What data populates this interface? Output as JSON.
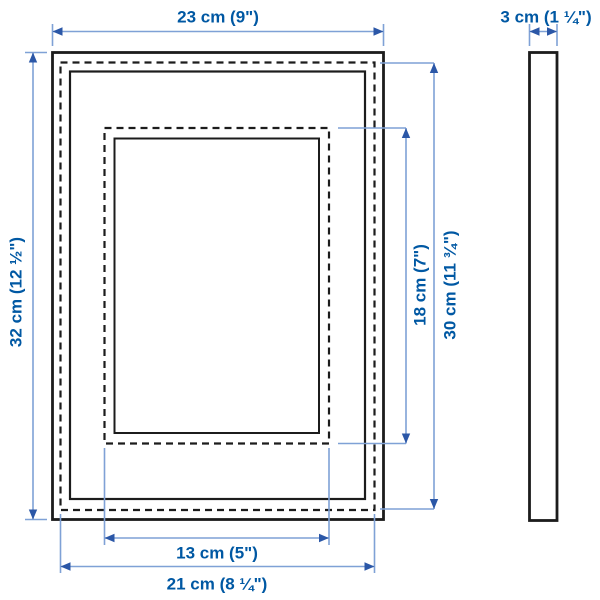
{
  "colors": {
    "label": "#0058a3",
    "dimline": "#7fa1d6",
    "arrow": "#2b57a7",
    "frame": "#1c1c1c",
    "bg": "#ffffff"
  },
  "diagram": {
    "type": "product-dimension-diagram",
    "subject": "picture frame, front view with mat outlines and side profile"
  },
  "labels": {
    "outer_width": "23 cm (9\")",
    "depth": "3 cm (1 ¼\")",
    "outer_height": "32 cm (12 ½\")",
    "mat_opening_height": "18 cm (7\")",
    "inner_picture_height": "30 cm (11 ¾\")",
    "mat_opening_width": "13 cm (5\")",
    "inner_picture_width": "21 cm (8 ¼\")"
  }
}
